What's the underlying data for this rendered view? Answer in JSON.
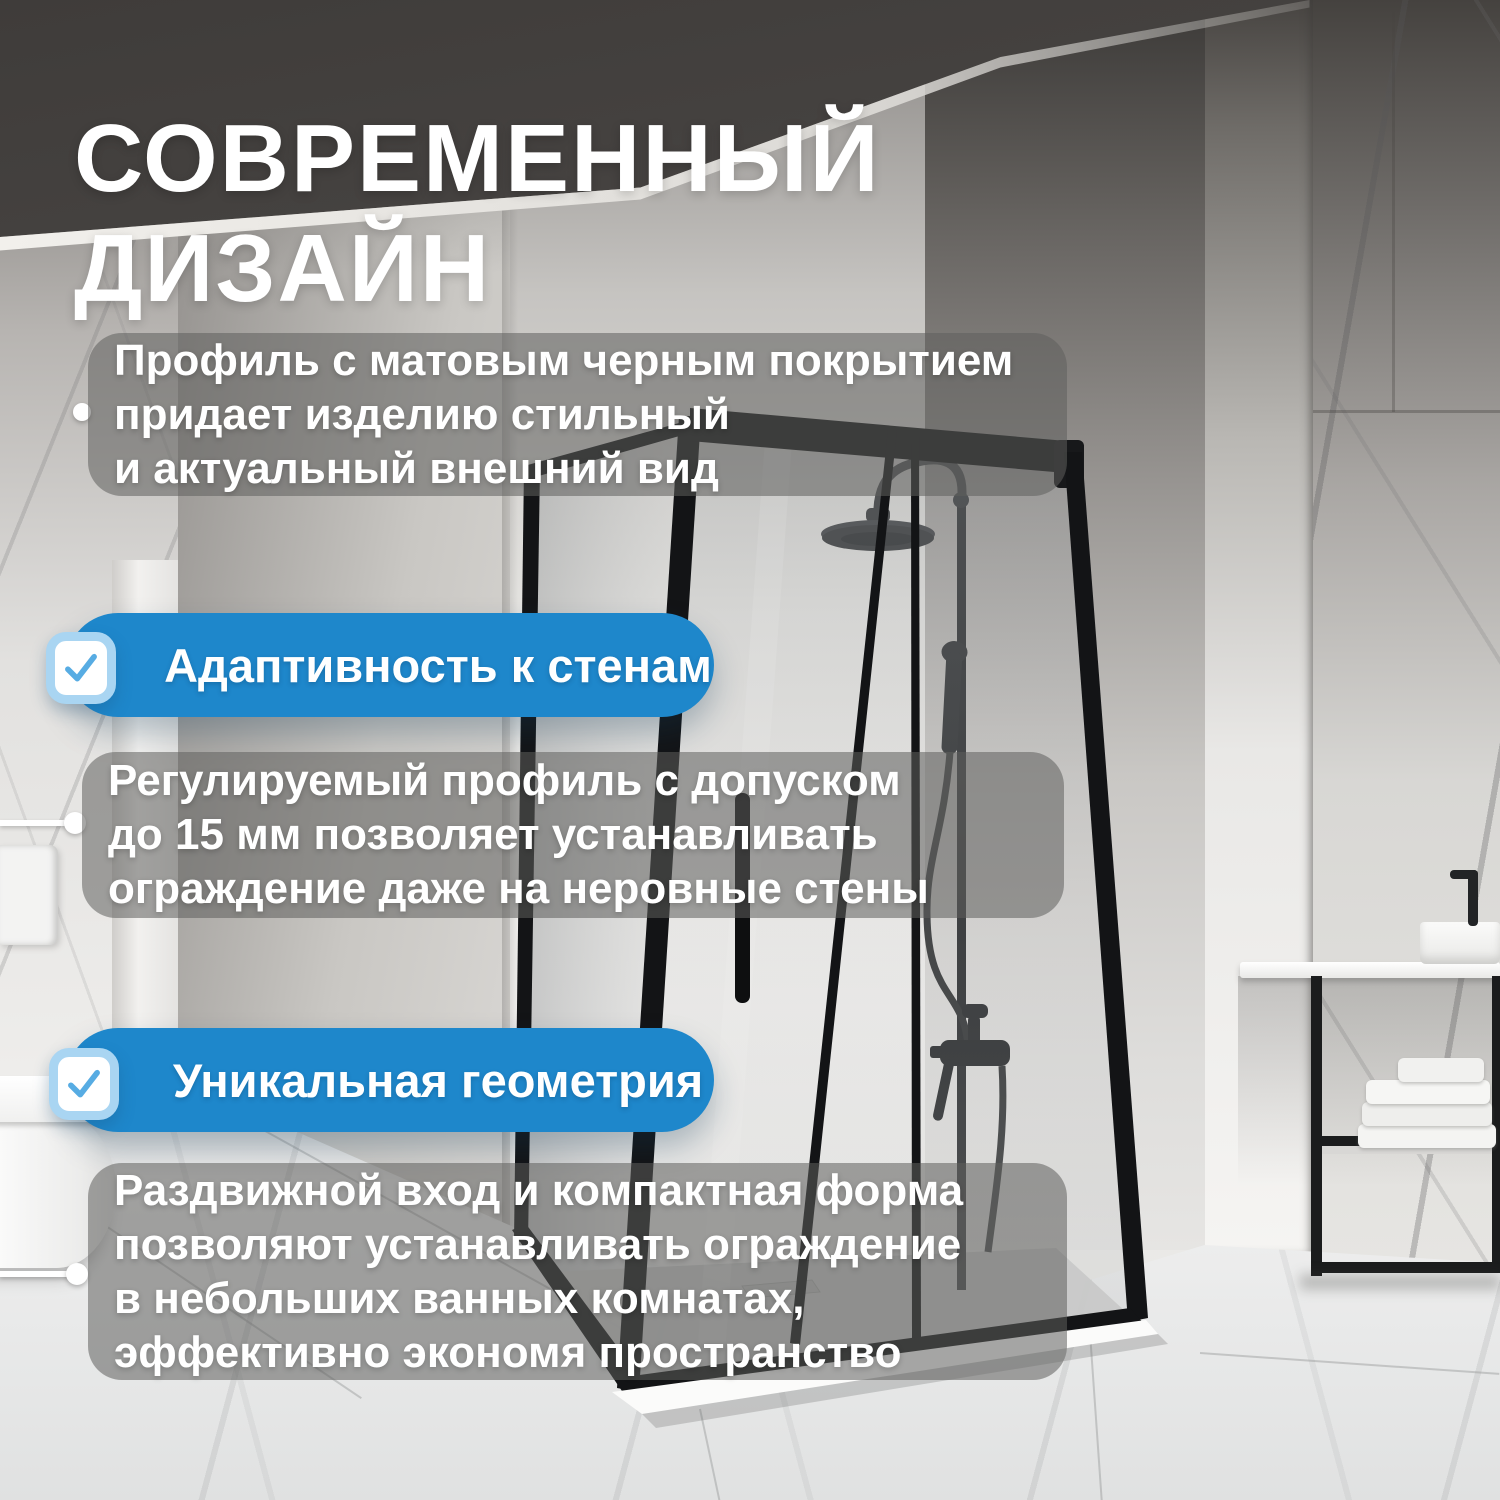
{
  "title": {
    "line1": "СОВРЕМЕННЫЙ",
    "line2": "ДИЗАЙН"
  },
  "panels": [
    {
      "lines": [
        "Профиль с матовым черным покрытием",
        "придает изделию стильный",
        "и актуальный внешний вид"
      ]
    },
    {
      "lines": [
        "Регулируемый профиль с допуском",
        "до 15 мм позволяет устанавливать",
        "ограждение даже на неровные стены"
      ]
    },
    {
      "lines": [
        "Раздвижной вход и компактная форма",
        "позволяют устанавливать ограждение",
        "в небольших ванных комнатах,",
        "эффективно экономя пространство"
      ]
    }
  ],
  "badges": [
    {
      "label": "Адаптивность к стенам",
      "icon": "checkmark-icon"
    },
    {
      "label": "Уникальная геометрия",
      "icon": "checkmark-icon"
    }
  ],
  "icons": {
    "checkmark": "✓"
  },
  "colors": {
    "accent_blue": "#1E87CB",
    "checkmark_blue": "#57ACE3",
    "checkbox_ring": "#A9D5F2",
    "panel_overlay": "rgba(94,94,92,0.55)",
    "title_text": "#FFFFFF"
  }
}
